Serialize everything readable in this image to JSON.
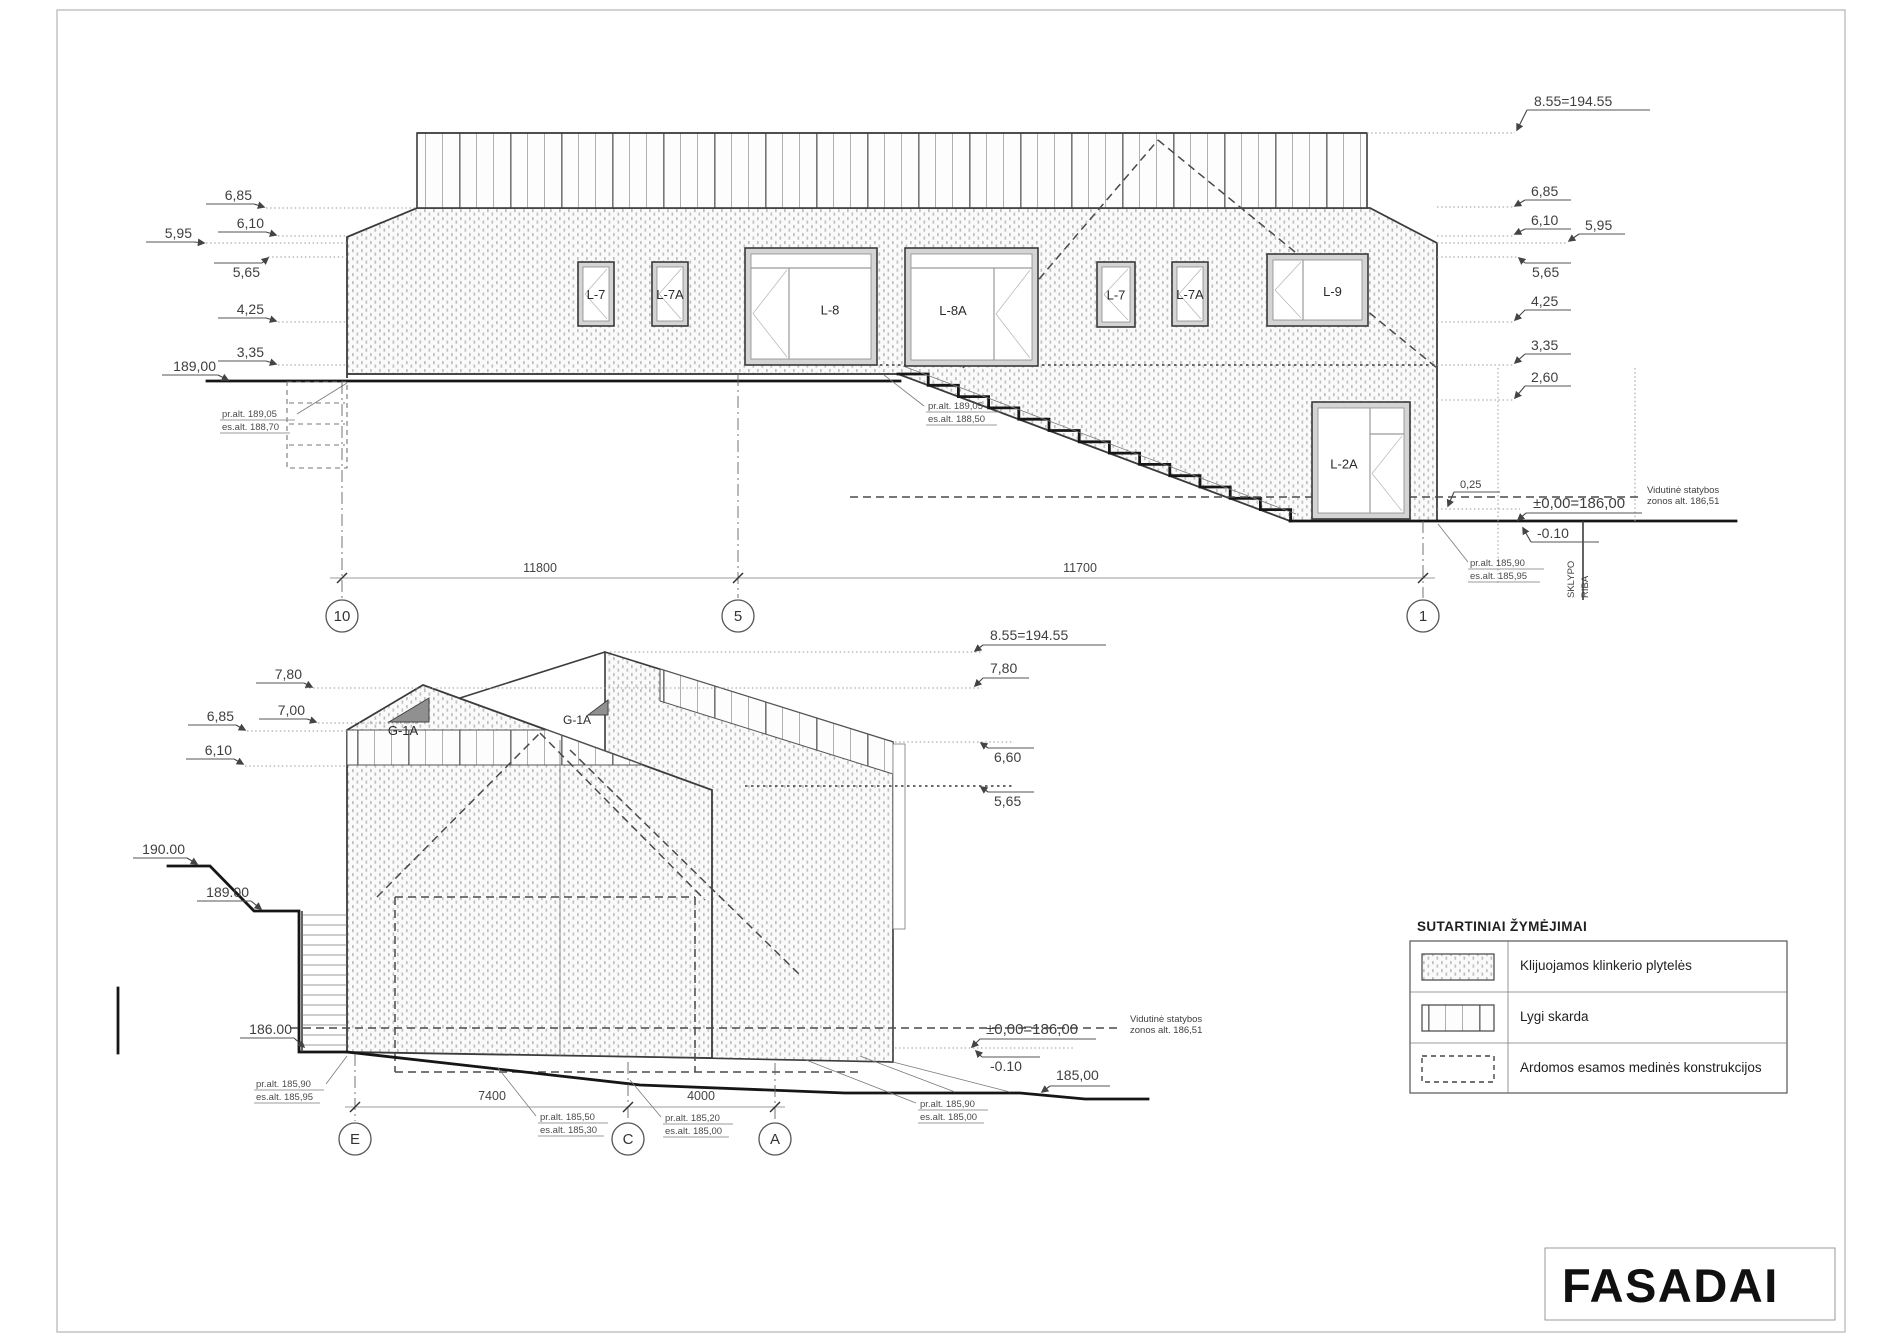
{
  "sheet": {
    "title": "FASADAI"
  },
  "legend": {
    "heading": "SUTARTINIAI ŽYMĖJIMAI",
    "items": [
      {
        "swatch": "klinker-hatch",
        "label": "Klijuojamos klinkerio plytelės"
      },
      {
        "swatch": "skarda-lines",
        "label": "Lygi skarda"
      },
      {
        "swatch": "dashed-outline",
        "label": "Ardomos esamos medinės konstrukcijos"
      }
    ]
  },
  "upper": {
    "ridge": "8.55=194.55",
    "left": {
      "l685": "6,85",
      "l610": "6,10",
      "l595": "5,95",
      "l565": "5,65",
      "l425": "4,25",
      "l335": "3,35",
      "street": "189,00"
    },
    "right": {
      "l685": "6,85",
      "l610": "6,10",
      "l595": "5,95",
      "l565": "5,65",
      "l425": "4,25",
      "l335": "3,35",
      "l260": "2,60",
      "l025": "0,25",
      "zero": "±0,00=186,00",
      "minus": "-0.10"
    },
    "windows": {
      "w1": "L-7",
      "w2": "L-7A",
      "w3": "L-8",
      "w4": "L-8A",
      "w5": "L-7",
      "w6": "L-7A",
      "w7": "L-9",
      "w8": "L-2A"
    },
    "notes": {
      "n1a": "pr.alt. 189,05",
      "n1b": "es.alt. 188,70",
      "n2a": "pr.alt. 189,05",
      "n2b": "es.alt. 188,50",
      "n3a": "pr.alt. 185,90",
      "n3b": "es.alt. 185,95"
    },
    "zone": {
      "a": "Vidutinė statybos",
      "b": "zonos alt. 186,51"
    },
    "boundary": {
      "a": "SKLYPO",
      "b": "RIBA"
    },
    "grids": {
      "g10": "10",
      "g5": "5",
      "g1": "1"
    },
    "dims": {
      "d1": "11800",
      "d2": "11700"
    }
  },
  "lower": {
    "ridge": "8.55=194.55",
    "left": {
      "l780": "7,80",
      "l700": "7,00",
      "l685": "6,85",
      "l610": "6,10",
      "t190": "190.00",
      "t189": "189.00",
      "t186": "186.00"
    },
    "right": {
      "l780": "7,80",
      "l660": "6,60",
      "l565": "5,65",
      "zero": "±0,00=186,00",
      "minus": "-0.10",
      "t185": "185,00"
    },
    "gables": {
      "ga": "G-1A",
      "gb": "G-1A"
    },
    "notes": {
      "n1a": "pr.alt. 185,90",
      "n1b": "es.alt. 185,95",
      "n2a": "pr.alt. 185,50",
      "n2b": "es.alt. 185,30",
      "n3a": "pr.alt. 185,20",
      "n3b": "es.alt. 185,00",
      "n4a": "pr.alt. 185,90",
      "n4b": "es.alt. 185,00"
    },
    "zone": {
      "a": "Vidutinė statybos",
      "b": "zonos alt. 186,51"
    },
    "grids": {
      "gE": "E",
      "gC": "C",
      "gA": "A"
    },
    "dims": {
      "d1": "7400",
      "d2": "4000"
    }
  }
}
